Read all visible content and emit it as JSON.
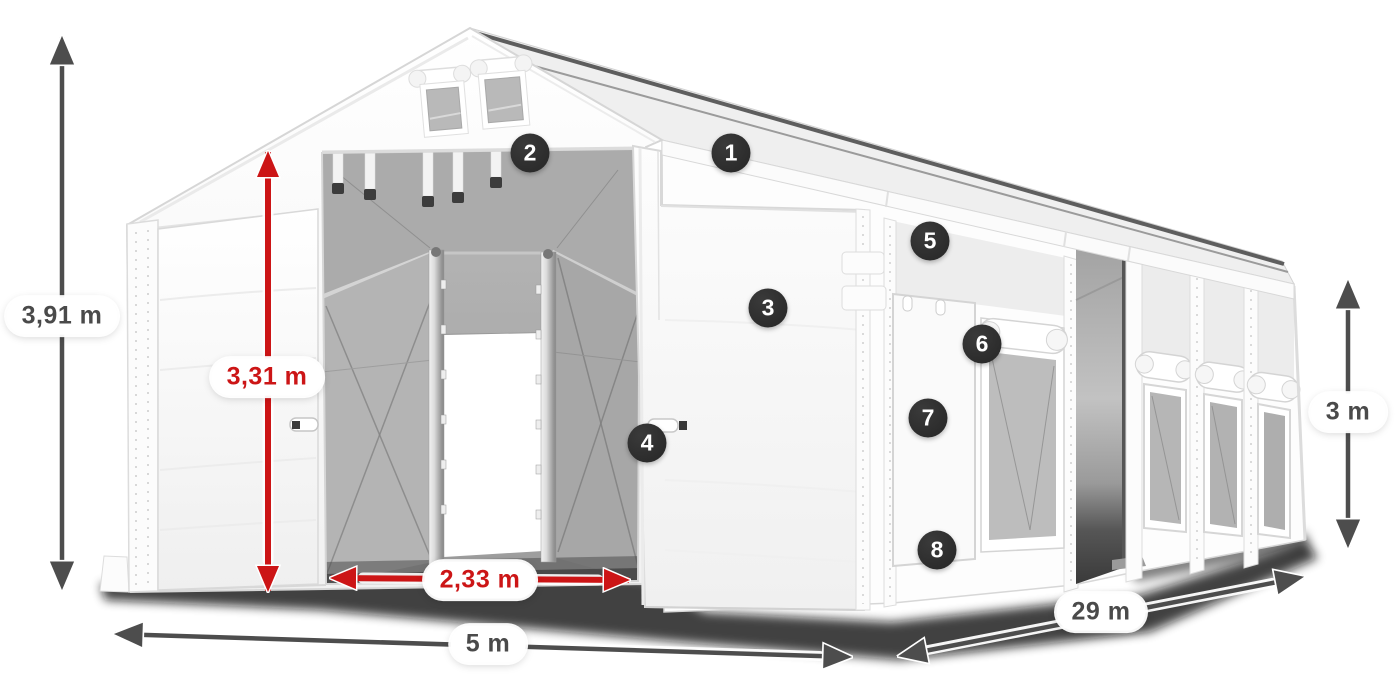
{
  "canvas": {
    "width": 1400,
    "height": 700,
    "background": "#ffffff"
  },
  "colors": {
    "dimension_dark": "#4d4d4d",
    "dimension_red": "#cc1516",
    "label_pill_bg": "#ffffff",
    "badge_bg": "#2b2b2b",
    "badge_text": "#ffffff",
    "tent_fabric": "#ffffff",
    "tent_interior_gray": "#a9a9a9",
    "mesh_window_gray": "#bdbdbd"
  },
  "icons": {
    "double_arrow_vertical": "↕",
    "double_arrow_horizontal": "↔",
    "hotspot_badge": "●"
  },
  "dimension_labels": {
    "total_height": {
      "text": "3,91 m",
      "style": "dark"
    },
    "entrance_height": {
      "text": "3,31 m",
      "style": "red"
    },
    "entrance_width": {
      "text": "2,33 m",
      "style": "red"
    },
    "front_width": {
      "text": "5 m",
      "style": "dark"
    },
    "side_length": {
      "text": "29 m",
      "style": "dark"
    },
    "wall_height": {
      "text": "3 m",
      "style": "dark"
    }
  },
  "feature_badges": [
    {
      "number": "1"
    },
    {
      "number": "2"
    },
    {
      "number": "3"
    },
    {
      "number": "4"
    },
    {
      "number": "5"
    },
    {
      "number": "6"
    },
    {
      "number": "7"
    },
    {
      "number": "8"
    }
  ]
}
